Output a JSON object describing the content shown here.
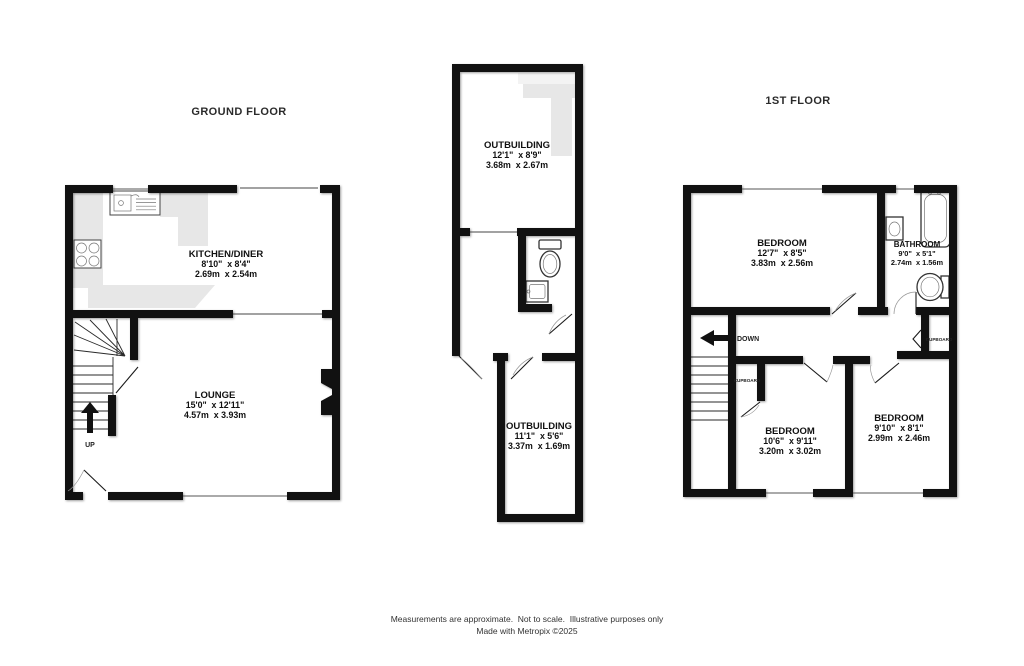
{
  "titles": {
    "ground_floor": "GROUND FLOOR",
    "first_floor": "1ST FLOOR"
  },
  "rooms": {
    "kitchen_diner": {
      "name": "KITCHEN/DINER",
      "imperial": "8'10\"  x 8'4\"",
      "metric": "2.69m  x 2.54m"
    },
    "lounge": {
      "name": "LOUNGE",
      "imperial": "15'0\"  x 12'11\"",
      "metric": "4.57m  x 3.93m"
    },
    "outbuilding_upper": {
      "name": "OUTBUILDING",
      "imperial": "12'1\"  x 8'9\"",
      "metric": "3.68m  x 2.67m"
    },
    "outbuilding_lower": {
      "name": "OUTBUILDING",
      "imperial": "11'1\"  x 5'6\"",
      "metric": "3.37m  x 1.69m"
    },
    "bedroom_one": {
      "name": "BEDROOM",
      "imperial": "12'7\"  x 8'5\"",
      "metric": "3.83m  x 2.56m"
    },
    "bathroom": {
      "name": "BATHROOM",
      "imperial": "9'0\"  x 5'1\"",
      "metric": "2.74m  x 1.56m"
    },
    "bedroom_two": {
      "name": "BEDROOM",
      "imperial": "10'6\"  x 9'11\"",
      "metric": "3.20m  x 3.02m"
    },
    "bedroom_three": {
      "name": "BEDROOM",
      "imperial": "9'10\"  x 8'1\"",
      "metric": "2.99m  x 2.46m"
    }
  },
  "annotations": {
    "up": "UP",
    "down": "DOWN",
    "cupboard_left": "CUPBOARD",
    "cupboard_right": "CUPBOARD"
  },
  "footer": {
    "line1": "Measurements are approximate.  Not to scale.  Illustrative purposes only",
    "line2": "Made with Metropix ©2025"
  },
  "colors": {
    "wall": "#111111",
    "fixture": "#e7e7e7",
    "background": "#ffffff"
  }
}
